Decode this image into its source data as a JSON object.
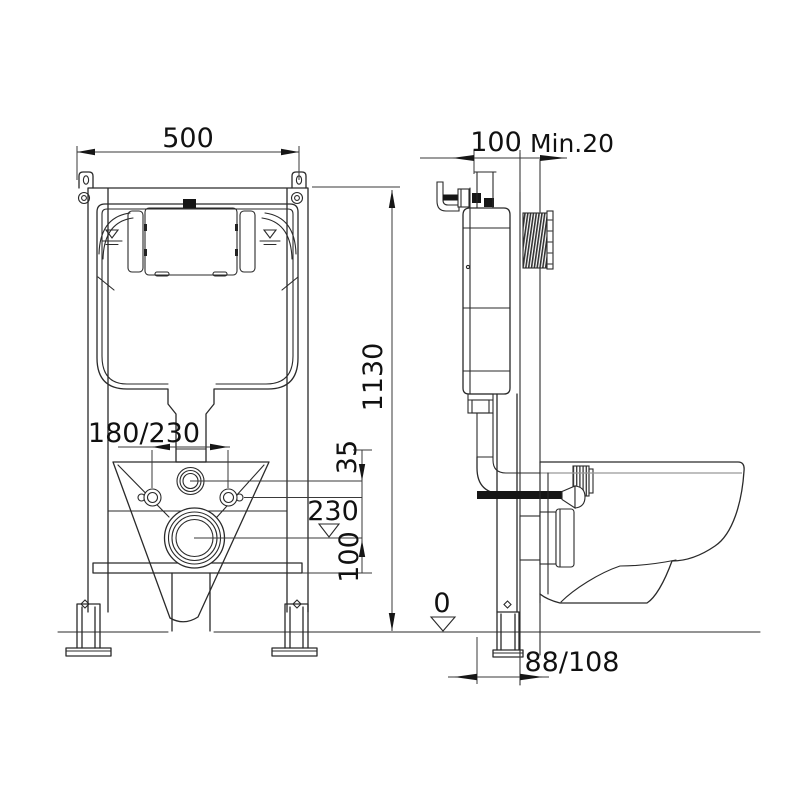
{
  "title": "Wall-hung WC concealed cistern frame installation drawing",
  "labels": {
    "frame_width": "500",
    "frame_height": "1130",
    "frame_depth": "100",
    "wall_min": "Min.20",
    "bolt_spacing": "180/230",
    "flush_offset": "35",
    "outlet_height": "230",
    "outlet_drop": "100",
    "floor_level": "0",
    "outlet_distance": "88/108"
  },
  "colors": {
    "line": "#2a2a2a",
    "background": "#ffffff",
    "hatch": "#333333"
  }
}
